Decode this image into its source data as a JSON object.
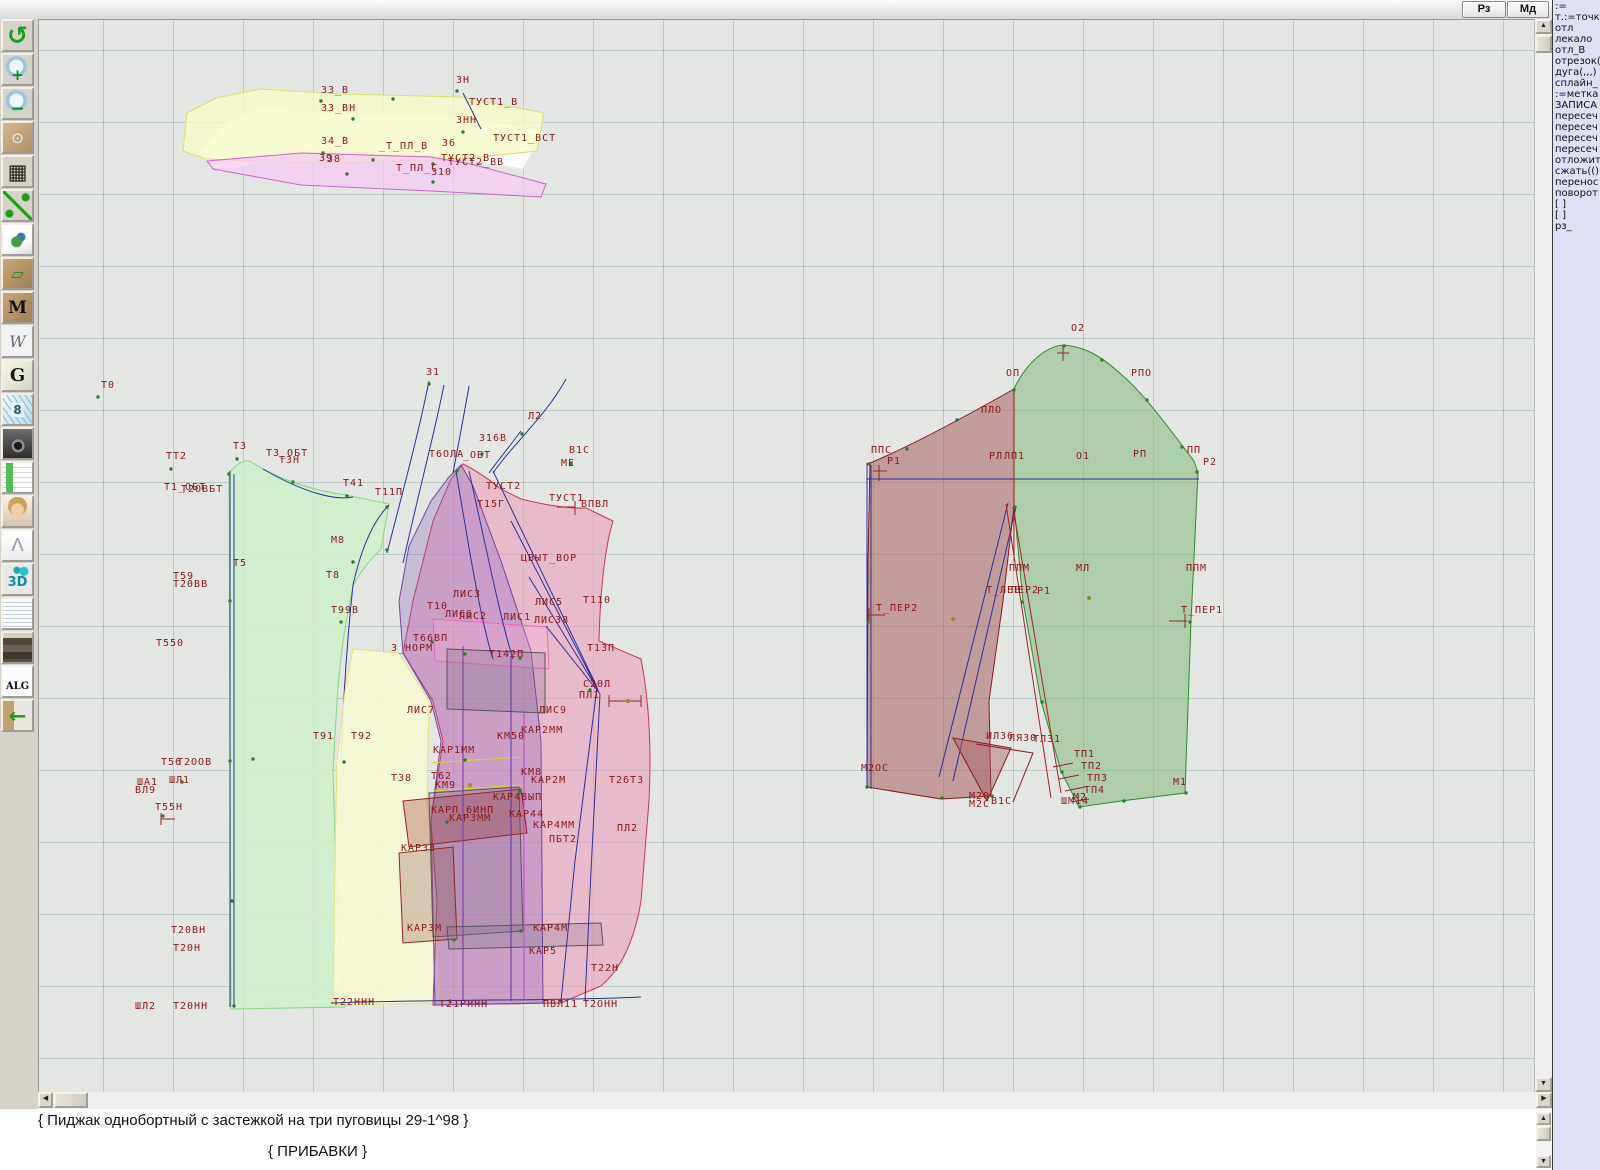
{
  "topbar": {
    "buttons": [
      {
        "label": "Рз"
      },
      {
        "label": "Мд"
      }
    ]
  },
  "toolbar": {
    "icons": [
      {
        "name": "refresh",
        "glyph": "↺"
      },
      {
        "name": "zoom-in",
        "glyph": "+"
      },
      {
        "name": "zoom-out",
        "glyph": "−"
      },
      {
        "name": "preview",
        "glyph": "⊙"
      },
      {
        "name": "grid",
        "glyph": "▦"
      },
      {
        "name": "measure",
        "glyph": ""
      },
      {
        "name": "image",
        "glyph": ""
      },
      {
        "name": "pattern",
        "glyph": "▱"
      },
      {
        "name": "pattern-m",
        "glyph": "M"
      },
      {
        "name": "compass",
        "glyph": "W"
      },
      {
        "name": "g",
        "glyph": "G"
      },
      {
        "name": "ruler",
        "glyph": "8"
      },
      {
        "name": "camera",
        "glyph": ""
      },
      {
        "name": "table",
        "glyph": ""
      },
      {
        "name": "portrait",
        "glyph": ""
      },
      {
        "name": "jacket",
        "glyph": "Λ"
      },
      {
        "name": "3d",
        "glyph": "3D"
      },
      {
        "name": "textdoc",
        "glyph": ""
      },
      {
        "name": "books",
        "glyph": ""
      },
      {
        "name": "alg",
        "glyph": "ALG"
      },
      {
        "name": "exit",
        "glyph": "←"
      }
    ]
  },
  "right_panel": {
    "lines": [
      ":=",
      "т.:=точка",
      "отл",
      "лекало",
      "отл_В",
      "отрезок(",
      "дуга(,,,)",
      "сплайн_",
      ":=метка",
      "ЗАПИСА",
      "пересеч",
      "пересеч",
      "пересеч",
      "пересеч",
      "отложит",
      "сжать(()",
      "перенос",
      "поворот",
      "[ ]",
      "[ ]",
      "рз_"
    ]
  },
  "status": {
    "line1": "{ Пиджак однобортный с застежкой на три пуговицы 29-1^98 }",
    "line2": "{  ПРИБАВКИ }"
  },
  "scroll": {
    "up": "▲",
    "down": "▼",
    "left": "◀",
    "right": "▶"
  },
  "colors": {
    "canvas_bg": "#e4e6e4",
    "grid": "#8cacac",
    "label": "#8c1616",
    "back_piece": "#cdf0c8",
    "yellow_piece": "#f6f8d2",
    "front_piece": "#eba0be",
    "overlay_piece": "#8c64be",
    "collar_yellow": "#f8fac8",
    "collar_pink": "#f6c8f4",
    "undersleeve": "#a55f5f",
    "uppersleeve": "#82b978",
    "outline_navy": "#27329b",
    "outline_red": "#8b1a1a",
    "panel_bg": "#dfdff8"
  },
  "canvas": {
    "labels": [
      {
        "x": 320,
        "y": 92,
        "t": "З3_В"
      },
      {
        "x": 320,
        "y": 110,
        "t": "З3_ВН"
      },
      {
        "x": 455,
        "y": 82,
        "t": "ЗН"
      },
      {
        "x": 468,
        "y": 104,
        "t": "ТУСТ1_В"
      },
      {
        "x": 455,
        "y": 122,
        "t": "ЗНН"
      },
      {
        "x": 320,
        "y": 143,
        "t": "З4_В"
      },
      {
        "x": 378,
        "y": 148,
        "t": "_Т_ПЛ_В"
      },
      {
        "x": 441,
        "y": 145,
        "t": "З6"
      },
      {
        "x": 492,
        "y": 140,
        "t": "ТУСТ1_ВСТ"
      },
      {
        "x": 440,
        "y": 160,
        "t": "ТУСТ2_В"
      },
      {
        "x": 318,
        "y": 160,
        "t": "З9"
      },
      {
        "x": 326,
        "y": 161,
        "t": "З8"
      },
      {
        "x": 395,
        "y": 170,
        "t": "Т_ПЛ_С"
      },
      {
        "x": 447,
        "y": 164,
        "t": "ТУСТ2_ВВ"
      },
      {
        "x": 430,
        "y": 174,
        "t": "З10"
      },
      {
        "x": 100,
        "y": 387,
        "t": "Т0"
      },
      {
        "x": 232,
        "y": 448,
        "t": "Т3"
      },
      {
        "x": 165,
        "y": 458,
        "t": "ТТ2"
      },
      {
        "x": 265,
        "y": 455,
        "t": "Т3_ОБТ"
      },
      {
        "x": 278,
        "y": 462,
        "t": "ТЗН"
      },
      {
        "x": 163,
        "y": 489,
        "t": "Т1_ОБТ"
      },
      {
        "x": 180,
        "y": 491,
        "t": "Т2ОВБТ"
      },
      {
        "x": 342,
        "y": 485,
        "t": "Т41"
      },
      {
        "x": 330,
        "y": 542,
        "t": "М8"
      },
      {
        "x": 232,
        "y": 565,
        "t": "Т5"
      },
      {
        "x": 172,
        "y": 578,
        "t": "Т59"
      },
      {
        "x": 172,
        "y": 586,
        "t": "Т20ВВ"
      },
      {
        "x": 325,
        "y": 577,
        "t": "Т8"
      },
      {
        "x": 330,
        "y": 612,
        "t": "Т99В"
      },
      {
        "x": 155,
        "y": 645,
        "t": "Т550"
      },
      {
        "x": 312,
        "y": 738,
        "t": "Т91"
      },
      {
        "x": 350,
        "y": 738,
        "t": "Т92"
      },
      {
        "x": 160,
        "y": 764,
        "t": "Т56"
      },
      {
        "x": 176,
        "y": 764,
        "t": "Т2ООВ"
      },
      {
        "x": 136,
        "y": 784,
        "t": "ША1"
      },
      {
        "x": 168,
        "y": 782,
        "t": "ШЛ1"
      },
      {
        "x": 134,
        "y": 792,
        "t": "ВЛ9"
      },
      {
        "x": 154,
        "y": 809,
        "t": "Т55Н"
      },
      {
        "x": 170,
        "y": 932,
        "t": "Т20ВН"
      },
      {
        "x": 172,
        "y": 950,
        "t": "Т20Н"
      },
      {
        "x": 134,
        "y": 1008,
        "t": "ШЛ2"
      },
      {
        "x": 172,
        "y": 1008,
        "t": "Т20НН"
      },
      {
        "x": 425,
        "y": 374,
        "t": "З1"
      },
      {
        "x": 527,
        "y": 418,
        "t": "Л2"
      },
      {
        "x": 478,
        "y": 440,
        "t": "З16В"
      },
      {
        "x": 428,
        "y": 456,
        "t": "Т6ОЛА"
      },
      {
        "x": 462,
        "y": 457,
        "t": "_ОБТ"
      },
      {
        "x": 568,
        "y": 452,
        "t": "В1С"
      },
      {
        "x": 560,
        "y": 465,
        "t": "МЕ"
      },
      {
        "x": 374,
        "y": 494,
        "t": "Т11П"
      },
      {
        "x": 485,
        "y": 488,
        "t": "ТУСТ2"
      },
      {
        "x": 476,
        "y": 506,
        "t": "Т15Г"
      },
      {
        "x": 548,
        "y": 500,
        "t": "ТУСТ1"
      },
      {
        "x": 580,
        "y": 506,
        "t": "ВПВЛ"
      },
      {
        "x": 520,
        "y": 560,
        "t": "ЦВЫТ_ВОР"
      },
      {
        "x": 426,
        "y": 608,
        "t": "Т10"
      },
      {
        "x": 452,
        "y": 596,
        "t": "ЛИС3"
      },
      {
        "x": 534,
        "y": 604,
        "t": "ЛИС5"
      },
      {
        "x": 582,
        "y": 602,
        "t": "Т110"
      },
      {
        "x": 444,
        "y": 616,
        "t": "ЛИС6"
      },
      {
        "x": 458,
        "y": 618,
        "t": "ЛИС2"
      },
      {
        "x": 502,
        "y": 619,
        "t": "ЛИС1"
      },
      {
        "x": 533,
        "y": 622,
        "t": "ЛИС38"
      },
      {
        "x": 412,
        "y": 640,
        "t": "Т66ВП"
      },
      {
        "x": 390,
        "y": 650,
        "t": "З_НОРМ"
      },
      {
        "x": 488,
        "y": 656,
        "t": "Т142П"
      },
      {
        "x": 586,
        "y": 650,
        "t": "Т13П"
      },
      {
        "x": 582,
        "y": 686,
        "t": "С20Л"
      },
      {
        "x": 578,
        "y": 697,
        "t": "ПЛ1"
      },
      {
        "x": 406,
        "y": 712,
        "t": "ЛИС7"
      },
      {
        "x": 538,
        "y": 712,
        "t": "ЛИС9"
      },
      {
        "x": 520,
        "y": 732,
        "t": "КАР2ММ"
      },
      {
        "x": 496,
        "y": 738,
        "t": "КМ50"
      },
      {
        "x": 432,
        "y": 752,
        "t": "КАР1ММ"
      },
      {
        "x": 390,
        "y": 780,
        "t": "Т38"
      },
      {
        "x": 430,
        "y": 778,
        "t": "Т62"
      },
      {
        "x": 434,
        "y": 787,
        "t": "КМ9"
      },
      {
        "x": 520,
        "y": 774,
        "t": "КМ8"
      },
      {
        "x": 530,
        "y": 782,
        "t": "КАР2М"
      },
      {
        "x": 608,
        "y": 782,
        "t": "Т26Т3"
      },
      {
        "x": 492,
        "y": 799,
        "t": "КАР4ВЫП"
      },
      {
        "x": 430,
        "y": 812,
        "t": "КАРП_6ИНП"
      },
      {
        "x": 448,
        "y": 820,
        "t": "КАР3ММ"
      },
      {
        "x": 508,
        "y": 816,
        "t": "КАР44"
      },
      {
        "x": 532,
        "y": 827,
        "t": "КАР4ММ"
      },
      {
        "x": 616,
        "y": 830,
        "t": "ПЛ2"
      },
      {
        "x": 548,
        "y": 841,
        "t": "ПБТ2"
      },
      {
        "x": 400,
        "y": 850,
        "t": "КАР33"
      },
      {
        "x": 406,
        "y": 930,
        "t": "КАР3М"
      },
      {
        "x": 532,
        "y": 930,
        "t": "КАР4М"
      },
      {
        "x": 528,
        "y": 953,
        "t": "КАР5"
      },
      {
        "x": 590,
        "y": 970,
        "t": "Т22Н"
      },
      {
        "x": 332,
        "y": 1004,
        "t": "Т22ННН"
      },
      {
        "x": 438,
        "y": 1006,
        "t": "Т21РННН"
      },
      {
        "x": 542,
        "y": 1006,
        "t": "ПВЛ11"
      },
      {
        "x": 582,
        "y": 1006,
        "t": "Т2ОНН"
      },
      {
        "x": 1070,
        "y": 330,
        "t": "О2"
      },
      {
        "x": 1005,
        "y": 375,
        "t": "ОП"
      },
      {
        "x": 1130,
        "y": 375,
        "t": "РПО"
      },
      {
        "x": 980,
        "y": 412,
        "t": "ПЛО"
      },
      {
        "x": 870,
        "y": 452,
        "t": "ППС"
      },
      {
        "x": 886,
        "y": 463,
        "t": "Р1"
      },
      {
        "x": 988,
        "y": 458,
        "t": "РЛ"
      },
      {
        "x": 1003,
        "y": 458,
        "t": "ЛП1"
      },
      {
        "x": 1075,
        "y": 458,
        "t": "О1"
      },
      {
        "x": 1132,
        "y": 456,
        "t": "РП"
      },
      {
        "x": 1186,
        "y": 452,
        "t": "ПП"
      },
      {
        "x": 1202,
        "y": 464,
        "t": "Р2"
      },
      {
        "x": 1008,
        "y": 570,
        "t": "ППМ"
      },
      {
        "x": 1075,
        "y": 570,
        "t": "МЛ"
      },
      {
        "x": 1185,
        "y": 570,
        "t": "ППМ"
      },
      {
        "x": 875,
        "y": 610,
        "t": "Т_ПЕР2"
      },
      {
        "x": 985,
        "y": 592,
        "t": "Т_ЛЕВ"
      },
      {
        "x": 1010,
        "y": 592,
        "t": "ПЕР2"
      },
      {
        "x": 1036,
        "y": 593,
        "t": "Р1"
      },
      {
        "x": 1180,
        "y": 612,
        "t": "Т_ПЕР1"
      },
      {
        "x": 985,
        "y": 738,
        "t": "ИЛ36"
      },
      {
        "x": 1008,
        "y": 740,
        "t": "ЛЯ30"
      },
      {
        "x": 1032,
        "y": 741,
        "t": "ТЛ31"
      },
      {
        "x": 1073,
        "y": 756,
        "t": "ТП1"
      },
      {
        "x": 1080,
        "y": 768,
        "t": "ТП2"
      },
      {
        "x": 1086,
        "y": 780,
        "t": "ТП3"
      },
      {
        "x": 1083,
        "y": 792,
        "t": "ТП4"
      },
      {
        "x": 1072,
        "y": 799,
        "t": "М2"
      },
      {
        "x": 860,
        "y": 770,
        "t": "М2ОС"
      },
      {
        "x": 968,
        "y": 798,
        "t": "М20"
      },
      {
        "x": 968,
        "y": 806,
        "t": "М2С"
      },
      {
        "x": 990,
        "y": 803,
        "t": "В1С"
      },
      {
        "x": 1060,
        "y": 803,
        "t": "ШМ14"
      },
      {
        "x": 1172,
        "y": 784,
        "t": "М1"
      }
    ]
  }
}
